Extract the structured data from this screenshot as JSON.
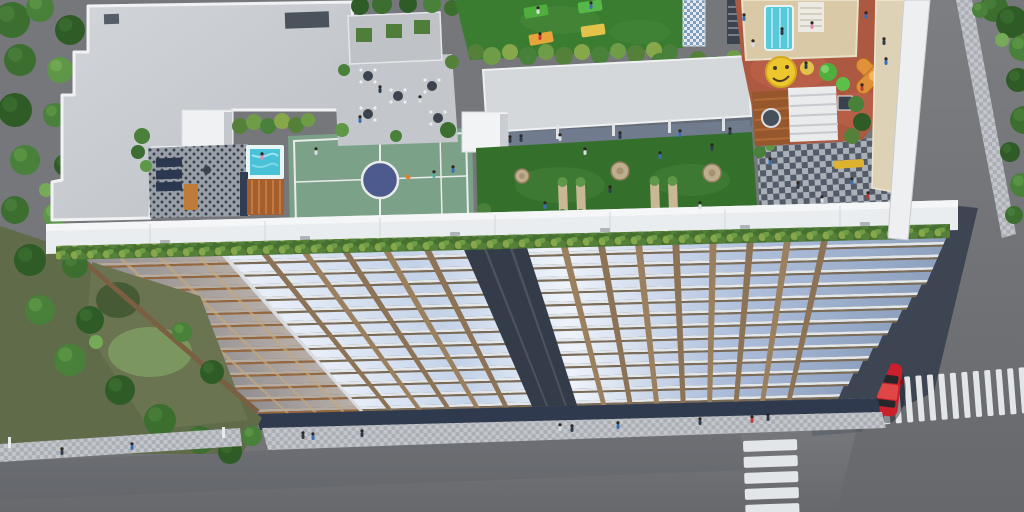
{
  "scene": {
    "type": "aerial-3d-architectural-rendering",
    "subject": "residential tower with rooftop amenity deck, street corner with crosswalks",
    "rooftop": {
      "amenities": [
        "concrete roof slab",
        "stair core",
        "lounge terrace",
        "plunge pool",
        "wood pool deck",
        "multipurpose sports court",
        "cafe courtyard",
        "planter wall",
        "yoga lawn",
        "canopy roof walkway",
        "seating lawn with stone pads",
        "garden benches",
        "checkered plaza",
        "kids play area",
        "water slide platform",
        "smiley ground art",
        "topiary trees",
        "orange climbing frame",
        "pergola",
        "round deck table"
      ],
      "yoga_mats": [
        [
          524,
          6,
          -10,
          "#4fae3e"
        ],
        [
          578,
          1,
          -8,
          "#57b84a"
        ],
        [
          581,
          25,
          -8,
          "#e2c249"
        ],
        [
          529,
          33,
          -10,
          "#e6a43a"
        ]
      ],
      "stone_pads": [
        [
          522,
          176,
          7
        ],
        [
          620,
          171,
          9
        ],
        [
          712,
          173,
          9
        ]
      ],
      "benches": [
        [
          558,
          184
        ],
        [
          576,
          184
        ],
        [
          650,
          183
        ],
        [
          668,
          183
        ]
      ],
      "court_center": [
        380,
        180
      ],
      "ball": [
        408,
        177
      ]
    },
    "street": {
      "crosswalk_vertical": {
        "x": 744,
        "y": 440,
        "stripe_w": 54,
        "stripe_h": 11,
        "gap": 16,
        "count": 5,
        "rot": -2
      },
      "crosswalk_horizontal": {
        "x0": 814,
        "y": 384,
        "stripe_w": 6,
        "stripe_h": 46,
        "pitch": 11.5,
        "count": 19,
        "rot": -4.5
      },
      "red_car": {
        "x": 888,
        "y": 390,
        "rot": 7
      },
      "sidewalks": [
        "front sidewalk",
        "left sidewalk",
        "right sidewalk strip"
      ]
    },
    "people": [
      [
        316,
        152,
        "#d9dee3"
      ],
      [
        434,
        175,
        "#4fb0a5"
      ],
      [
        453,
        170,
        "#3a6fb5"
      ],
      [
        262,
        157,
        "#e08bb0"
      ],
      [
        521,
        139,
        "#2e3b4a"
      ],
      [
        545,
        206,
        "#3a6fb5"
      ],
      [
        585,
        152,
        "#d9dee3"
      ],
      [
        610,
        190,
        "#2e3b4a"
      ],
      [
        660,
        156,
        "#3a6fb5"
      ],
      [
        700,
        206,
        "#d9dee3"
      ],
      [
        712,
        148,
        "#2e3b4a"
      ],
      [
        770,
        162,
        "#3a6fb5"
      ],
      [
        798,
        186,
        "#2e3b4a"
      ],
      [
        822,
        200,
        "#d9dee3"
      ],
      [
        852,
        182,
        "#3a6fb5"
      ],
      [
        868,
        196,
        "#c23a35"
      ],
      [
        744,
        18,
        "#3a6fb5"
      ],
      [
        753,
        44,
        "#d9dee3"
      ],
      [
        866,
        16,
        "#3a6fb5"
      ],
      [
        884,
        42,
        "#2e3b4a"
      ],
      [
        812,
        26,
        "#e08bb0"
      ],
      [
        782,
        32,
        "#2e3b4a"
      ],
      [
        806,
        66,
        "#2e3b4a"
      ],
      [
        886,
        62,
        "#3a6fb5"
      ],
      [
        862,
        88,
        "#c23a35"
      ],
      [
        538,
        11,
        "#d9dee3"
      ],
      [
        591,
        6,
        "#3a6fb5"
      ],
      [
        540,
        37,
        "#c23a35"
      ],
      [
        380,
        90,
        "#2e3b4a"
      ],
      [
        420,
        100,
        "#d9dee3"
      ],
      [
        360,
        120,
        "#3a6fb5"
      ],
      [
        510,
        140,
        "#2e3b4a"
      ],
      [
        560,
        138,
        "#d9dee3"
      ],
      [
        620,
        136,
        "#2e3b4a"
      ],
      [
        680,
        134,
        "#3a6fb5"
      ],
      [
        730,
        132,
        "#2e3b4a"
      ],
      [
        303,
        436,
        "#2e3b4a"
      ],
      [
        313,
        437,
        "#3a6fb5"
      ],
      [
        362,
        434,
        "#2e3b4a"
      ],
      [
        560,
        428,
        "#d9dee3"
      ],
      [
        572,
        429,
        "#2e3b4a"
      ],
      [
        618,
        426,
        "#3a6fb5"
      ],
      [
        700,
        422,
        "#2e3b4a"
      ],
      [
        752,
        420,
        "#c23a35"
      ],
      [
        768,
        418,
        "#2e3b4a"
      ],
      [
        62,
        452,
        "#2e3b4a"
      ],
      [
        132,
        447,
        "#3a6fb5"
      ]
    ],
    "trees_left": [
      [
        12,
        20,
        18,
        1
      ],
      [
        40,
        8,
        14,
        2
      ],
      [
        70,
        30,
        15,
        0
      ],
      [
        20,
        60,
        16,
        1
      ],
      [
        60,
        70,
        13,
        3
      ],
      [
        15,
        110,
        17,
        0
      ],
      [
        55,
        115,
        12,
        2
      ],
      [
        25,
        160,
        15,
        2
      ],
      [
        65,
        165,
        11,
        0
      ],
      [
        15,
        210,
        14,
        1
      ],
      [
        55,
        215,
        12,
        3
      ],
      [
        30,
        260,
        16,
        0
      ],
      [
        75,
        265,
        13,
        1
      ],
      [
        40,
        310,
        15,
        2
      ],
      [
        90,
        320,
        14,
        0
      ],
      [
        70,
        360,
        16,
        2
      ],
      [
        120,
        390,
        15,
        0
      ],
      [
        160,
        420,
        16,
        1
      ],
      [
        200,
        440,
        14,
        1
      ],
      [
        230,
        452,
        12,
        0
      ],
      [
        252,
        436,
        10,
        2
      ],
      [
        108,
        62,
        8,
        4
      ],
      [
        46,
        190,
        7,
        4
      ],
      [
        96,
        342,
        7,
        4
      ],
      [
        182,
        332,
        10,
        2
      ],
      [
        212,
        372,
        12,
        0
      ]
    ],
    "trees_right": [
      [
        994,
        8,
        14,
        1
      ],
      [
        1012,
        22,
        16,
        0
      ],
      [
        1022,
        48,
        13,
        2
      ],
      [
        1018,
        80,
        12,
        0
      ],
      [
        1024,
        120,
        14,
        1
      ],
      [
        1010,
        152,
        10,
        0
      ],
      [
        1022,
        185,
        12,
        2
      ],
      [
        1014,
        215,
        9,
        1
      ],
      [
        1002,
        40,
        7,
        4
      ],
      [
        980,
        10,
        8,
        2
      ]
    ]
  },
  "palette": {
    "roadLit": "#75777b",
    "roadDark": "#64666a",
    "shadowNavy": "#3d4553",
    "sidewalkA": "#c3c6ca",
    "sidewalkB": "#abafb5",
    "crosswalkWhite": "#e2e6e9",
    "carRed": "#c9202c",
    "slabGrey": "#c9cdd2",
    "parapetWhite": "#eaedef",
    "courtGreen": "#7ca189",
    "courtCircle": "#4c5a8e",
    "lineWhite": "#e9ece9",
    "poolWater": "#49c2d8",
    "poolRim": "#e8f6f8",
    "woodDeck": "#a55f2e",
    "terracotta": "#ad5840",
    "smileyYellow": "#eec72f",
    "playOrange": "#e0913a",
    "lawnDark": "#356f2c",
    "yogaLawn": "#3a7d31",
    "hedgeGreen": "#5d9747",
    "canopyGrey": "#d5d8db",
    "terraceGrey": "#9aa0a8",
    "terraceDot": "#39424d",
    "plazaLight": "#aab0b7",
    "plazaDark": "#525b67",
    "glassBlue": "#bccce6",
    "frameBrown": "#8d7356",
    "gapNavy": "#343c49",
    "benchYellow": "#ddb22e",
    "beigeWall": "#ded2b6",
    "stoneBeige": "#bfae8e",
    "dirtGreen": "#5f6b49",
    "treeShades": [
      "#2f5c26",
      "#3c6e2f",
      "#49803a",
      "#5d9747",
      "#76aa58",
      "#223f1c"
    ]
  },
  "building": {
    "floors_visible": 13,
    "facade": {
      "corners": {
        "tl": [
          78,
          256
        ],
        "tr": [
          948,
          234
        ],
        "br": [
          876,
          398
        ],
        "bl": [
          260,
          414
        ]
      },
      "floors": 13,
      "slab": "#e4e7ea",
      "gap": "#7b6a54",
      "gapLeft": "#b2713e",
      "leftZoneEnd": 0.165,
      "leftOverlay": "rgba(120,88,58,0.42)",
      "mullions": [
        0.212,
        0.259,
        0.306,
        0.353,
        0.4,
        0.558,
        0.601,
        0.644,
        0.687,
        0.73,
        0.773,
        0.816,
        0.859
      ],
      "mullionColor": "#8d7356",
      "mullionAlt": "#9b8060",
      "centerGap": [
        0.442,
        0.515
      ],
      "centerGapColor": "#343c49",
      "rightStepStart": 4,
      "rightStepSize": 4.2,
      "shadow": "#3d4553"
    }
  }
}
